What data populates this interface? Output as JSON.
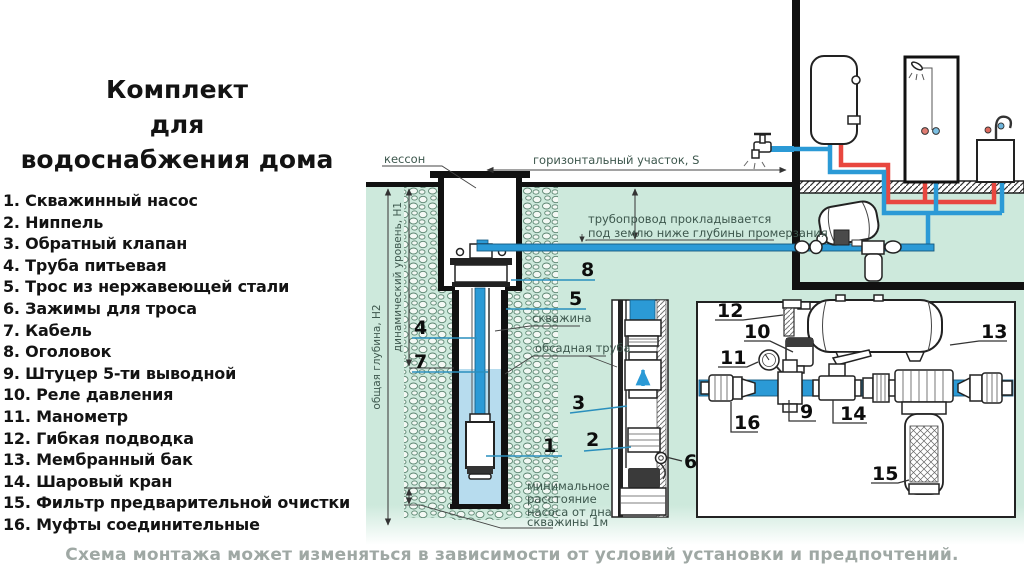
{
  "title": {
    "line1": "Комплект",
    "line2": "для",
    "line3": "водоснабжения дома"
  },
  "parts": {
    "items": [
      "1. Скважинный насос",
      "2. Ниппель",
      "3. Обратный клапан",
      "4. Труба питьевая",
      "5. Трос из нержавеющей стали",
      "6. Зажимы для троса",
      "7. Кабель",
      "8. Оголовок",
      "9. Штуцер 5-ти выводной",
      "10. Реле давления",
      "11. Манометр",
      "12. Гибкая подводка",
      "13. Мембранный бак",
      "14. Шаровый кран",
      "15. Фильтр предварительной очистки",
      "16. Муфты соединительные"
    ]
  },
  "diagram": {
    "labels": {
      "caisson": "кессон",
      "horizontal_run": "горизонтальный участок, S",
      "pipeline_note_line1": "трубопровод прокладывается",
      "pipeline_note_line2": "под землю ниже глубины промерзания",
      "borehole": "скважина",
      "casing_pipe": "обсадная труба",
      "total_depth": "общая глубина, Н2",
      "dynamic_level": "динамический уровень, Н1",
      "min_distance_line1": "минимальное",
      "min_distance_line2": "расстояние",
      "min_distance_line3": "насоса от дна",
      "min_distance_line4": "скважины 1м"
    },
    "callouts": {
      "c1": "1",
      "c2": "2",
      "c3": "3",
      "c4": "4",
      "c5": "5",
      "c6": "6",
      "c7": "7",
      "c8": "8",
      "c9": "9",
      "c10": "10",
      "c11": "11",
      "c12": "12",
      "c13": "13",
      "c14": "14",
      "c15": "15",
      "c16": "16"
    }
  },
  "caption": "Схема монтажа может изменяться в зависимости от условий установки и предпочтений.",
  "colors": {
    "pipe_cold_blue": "#2b9ad6",
    "pipe_hot_red": "#e8473f",
    "underground_green": "#cde9dc",
    "well_water_blue": "#b7dcee",
    "leader_blue": "#2a8fbd",
    "outline_black": "#111111",
    "caption_gray": "#9fa8a4"
  }
}
